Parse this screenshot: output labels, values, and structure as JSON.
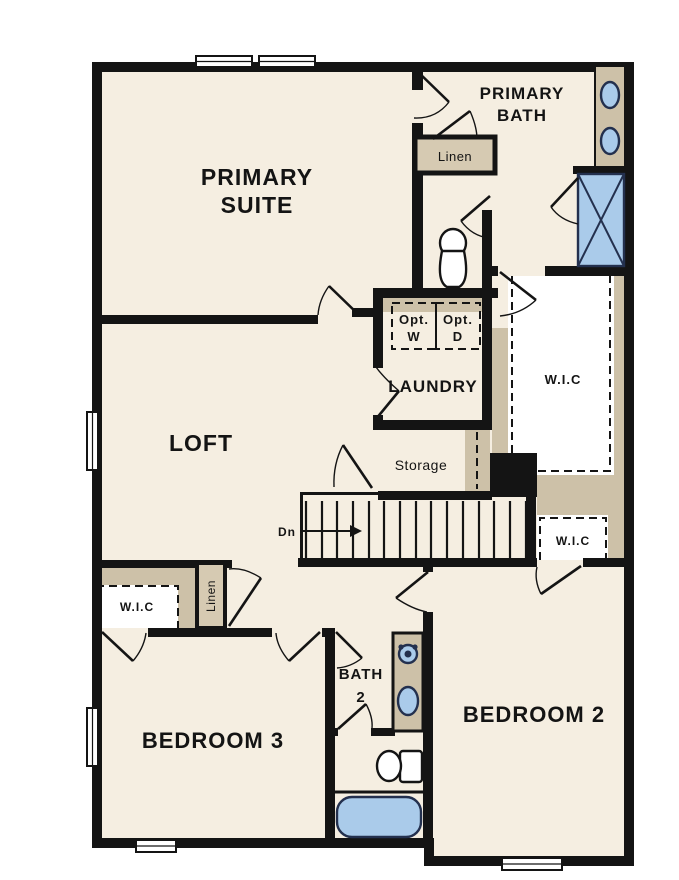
{
  "diagram_type": "residential-floor-plan-second-floor",
  "floor": {
    "rooms": {
      "primary_suite": {
        "label_line1": "PRIMARY",
        "label_line2": "SUITE"
      },
      "primary_bath": {
        "label_line1": "PRIMARY",
        "label_line2": "BATH"
      },
      "loft": {
        "label": "LOFT"
      },
      "laundry": {
        "label": "LAUNDRY"
      },
      "storage": {
        "label": "Storage"
      },
      "bedroom2": {
        "label": "BEDROOM 2"
      },
      "bedroom3": {
        "label": "BEDROOM 3"
      },
      "bath2": {
        "label_line1": "BATH",
        "label_line2": "2"
      }
    },
    "closets": {
      "linen_upper": {
        "label": "Linen"
      },
      "linen_lower": {
        "label": "Linen"
      },
      "wic_primary": {
        "label": "W.I.C"
      },
      "wic_bedroom2": {
        "label": "W.I.C"
      },
      "wic_bedroom3": {
        "label": "W.I.C"
      }
    },
    "laundry_appliances": {
      "washer_line1": "Opt.",
      "washer_line2": "W",
      "dryer_line1": "Opt.",
      "dryer_line2": "D"
    },
    "stairs": {
      "direction_label": "Dn"
    },
    "fixtures": [
      "double-vanity-two-sinks",
      "shower",
      "toilet-water-closet",
      "bath2-vanity-sink",
      "bath2-faucet",
      "bath2-toilet",
      "bathtub"
    ],
    "window_count": 6
  },
  "colors": {
    "floor": "#f5eee1",
    "wall": "#141414",
    "tan": "#cdc1a8",
    "tan_light": "#d6cab2",
    "appliance_gray": "#dcdcdc",
    "fixture_blue": "#aacbea",
    "fixture_stroke": "#23304e",
    "text": "#141414",
    "page": "#ffffff"
  }
}
